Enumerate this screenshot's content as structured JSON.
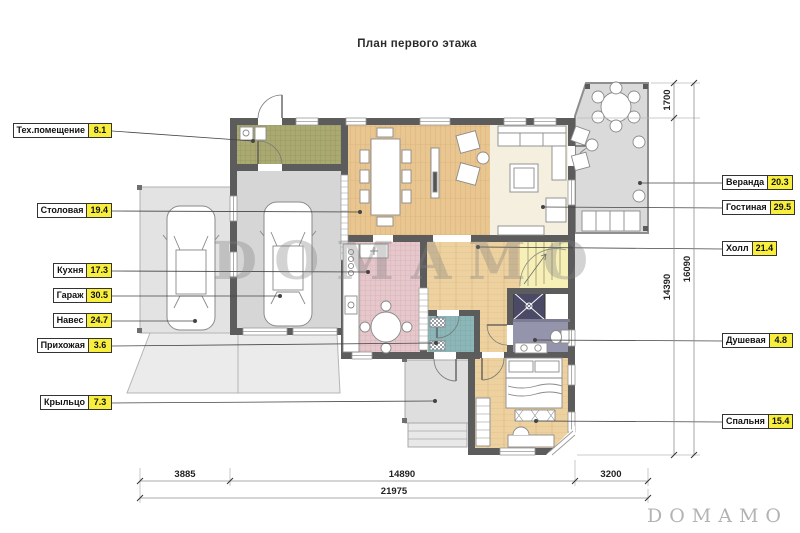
{
  "title": "План первого этажа",
  "watermark": {
    "center": "DOMAMO",
    "corner": "DOMAMO"
  },
  "labels_left": [
    {
      "name": "Тех.помещение",
      "value": "8.1"
    },
    {
      "name": "Столовая",
      "value": "19.4"
    },
    {
      "name": "Кухня",
      "value": "17.3"
    },
    {
      "name": "Гараж",
      "value": "30.5"
    },
    {
      "name": "Навес",
      "value": "24.7"
    },
    {
      "name": "Прихожая",
      "value": "3.6"
    },
    {
      "name": "Крыльцо",
      "value": "7.3"
    }
  ],
  "labels_right": [
    {
      "name": "Веранда",
      "value": "20.3"
    },
    {
      "name": "Гостиная",
      "value": "29.5"
    },
    {
      "name": "Холл",
      "value": "21.4"
    },
    {
      "name": "Душевая",
      "value": "4.8"
    },
    {
      "name": "Спальня",
      "value": "15.4"
    }
  ],
  "dimensions": {
    "bottom": [
      "3885",
      "14890",
      "3200"
    ],
    "bottom_total": "21975",
    "right": [
      "1700",
      "14390"
    ],
    "right_total": "16090"
  },
  "colors": {
    "wall": "#5c5c5c",
    "label_value_bg": "#f7ee3e",
    "tech_floor": "#a9a971",
    "wood_floor": "#e9c58f",
    "hall_floor": "#edd2a0",
    "kitchen_floor": "#e6c7cb",
    "entry_floor": "#8cb6b8",
    "shower_floor": "#9494ac",
    "living_floor": "#f4efdf",
    "gray_floor": "#d8d8d8"
  }
}
